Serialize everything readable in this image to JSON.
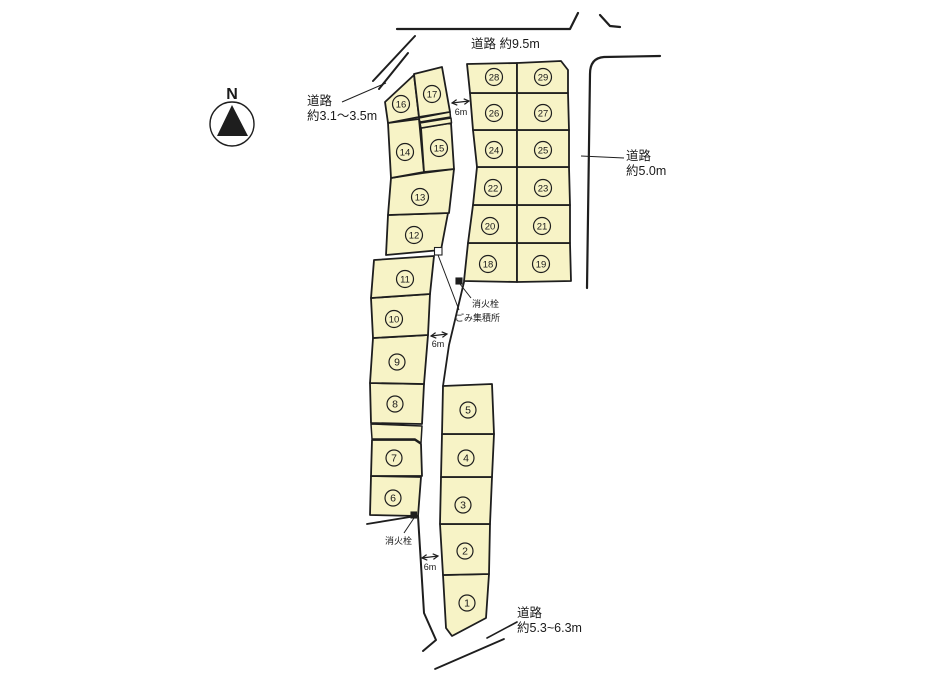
{
  "page": {
    "width": 947,
    "height": 681,
    "background": "#ffffff"
  },
  "colors": {
    "plot_fill": "#f7f3c6",
    "line": "#1e1e1e",
    "text": "#1a1a1a",
    "marker_dark": "#1e1e1e",
    "marker_light": "#ffffff"
  },
  "compass": {
    "label": "N",
    "cx": 232,
    "cy": 124,
    "r": 22
  },
  "road_labels": [
    {
      "id": "road-north",
      "lines": [
        "道路 約9.5m"
      ],
      "x": 471,
      "y": 48,
      "size": 12.5
    },
    {
      "id": "road-west",
      "lines": [
        "道路",
        "約3.1〜3.5m"
      ],
      "x": 307,
      "y": 105,
      "size": 12.5
    },
    {
      "id": "road-east",
      "lines": [
        "道路",
        "約5.0m"
      ],
      "x": 626,
      "y": 160,
      "size": 12.5
    },
    {
      "id": "road-south",
      "lines": [
        "道路",
        "約5.3~6.3m"
      ],
      "x": 517,
      "y": 617,
      "size": 12.5
    }
  ],
  "poi_labels": [
    {
      "id": "fire-hydrant-upper",
      "text": "消火栓",
      "x": 472,
      "y": 307,
      "size": 9
    },
    {
      "id": "garbage-station",
      "text": "ごみ集積所",
      "x": 455,
      "y": 321,
      "size": 9
    },
    {
      "id": "fire-hydrant-lower",
      "text": "消火栓",
      "x": 385,
      "y": 544,
      "size": 9
    }
  ],
  "dim_arrows": [
    {
      "id": "width-top",
      "x1": 452,
      "y1": 103,
      "x2": 469,
      "y2": 101,
      "label": "6m",
      "lx": 461,
      "ly": 115
    },
    {
      "id": "width-middle",
      "x1": 431,
      "y1": 336,
      "x2": 447,
      "y2": 334,
      "label": "6m",
      "lx": 438,
      "ly": 347
    },
    {
      "id": "width-bottom",
      "x1": 422,
      "y1": 558,
      "x2": 438,
      "y2": 556,
      "label": "6m",
      "lx": 430,
      "ly": 570
    }
  ],
  "markers": [
    {
      "id": "garbage-station-marker",
      "x": 434.5,
      "y": 247.5,
      "w": 7.5,
      "h": 7.5,
      "fill": "light"
    },
    {
      "id": "fire-hydrant-upper-marker",
      "x": 456,
      "y": 278,
      "w": 6,
      "h": 6,
      "fill": "dark"
    },
    {
      "id": "fire-hydrant-lower-marker",
      "x": 411,
      "y": 512,
      "w": 5.5,
      "h": 6,
      "fill": "dark"
    }
  ],
  "leader_lines": [
    {
      "id": "leader-road-west",
      "points": "342,102 386,83"
    },
    {
      "id": "leader-road-east",
      "points": "581,156 624,158"
    },
    {
      "id": "leader-garbage",
      "points": "438,255 459,310"
    },
    {
      "id": "leader-hydrant-up",
      "points": "460,284 471,298"
    },
    {
      "id": "leader-hydrant-lo",
      "points": "414,518 404,533"
    }
  ],
  "road_lines": [
    {
      "id": "road-top-edge",
      "points": "397,29 570,29 578,13",
      "w": 2.2
    },
    {
      "id": "road-top-corner",
      "points": "600,15 610,26 620,27",
      "w": 2.2
    },
    {
      "id": "road-east-edge",
      "path": "M660,56 L604,57 Q590,58 590,74 L587,288",
      "w": 2.2
    },
    {
      "id": "road-west-diag-outer",
      "points": "373,81 415,36",
      "w": 2
    },
    {
      "id": "road-west-diag-inner",
      "points": "379,89 408,53",
      "w": 2
    },
    {
      "id": "road-main-left-lower",
      "points": "418,516 424,613 436,640 423,651",
      "w": 2
    },
    {
      "id": "road-main-right-mid",
      "points": "464,282 455,320 449,345 443,386",
      "w": 1.8
    },
    {
      "id": "road-south-edge-a",
      "points": "517,622 487,638",
      "w": 1.6
    },
    {
      "id": "road-south-edge-b",
      "points": "504,639 435,669",
      "w": 1.8
    },
    {
      "id": "block-sliver-line",
      "points": "367,524 416,516",
      "w": 1.8
    }
  ],
  "strips": [
    {
      "id": "strip-17-15-a",
      "points": "419,118 450,112 450.5,117 420,122"
    },
    {
      "id": "strip-17-15-b",
      "points": "420,123 451,118 451.5,123 421,128"
    },
    {
      "id": "strip-8-7",
      "points": "371,424 422,426 421,443 415,439 372,439"
    }
  ],
  "plots": [
    {
      "n": "1",
      "points": "443,575 489,574 486,618 452,636 446,628",
      "cx": 467,
      "cy": 603
    },
    {
      "n": "2",
      "points": "440,524 490,524 489,574 443,575",
      "cx": 465,
      "cy": 551
    },
    {
      "n": "3",
      "points": "441,477 492,477 490,524 440,524",
      "cx": 463,
      "cy": 505
    },
    {
      "n": "4",
      "points": "442,434 494,434 492,477 441,477",
      "cx": 466,
      "cy": 458
    },
    {
      "n": "5",
      "points": "443,386 492,384 494,434 442,434",
      "cx": 468,
      "cy": 410
    },
    {
      "n": "6",
      "points": "371,476 421,477 418,516 370,515",
      "cx": 393,
      "cy": 498
    },
    {
      "n": "7",
      "points": "372,440 415,440 421,444 422,476 371,476",
      "cx": 394,
      "cy": 458
    },
    {
      "n": "8",
      "points": "370,383 424,384 422,424 371,423",
      "cx": 395,
      "cy": 404
    },
    {
      "n": "9",
      "points": "373,338 428,335 424,384 370,383",
      "cx": 397,
      "cy": 362
    },
    {
      "n": "10",
      "points": "371,298 430,294 428,335 373,338",
      "cx": 394,
      "cy": 319
    },
    {
      "n": "11",
      "points": "374,260 434,256 430,294 371,298",
      "cx": 405,
      "cy": 279
    },
    {
      "n": "12",
      "points": "388,215 448,213 441,250 386,255",
      "cx": 414,
      "cy": 235
    },
    {
      "n": "13",
      "points": "391,178 423,173 454,169 449,213 388,215",
      "cx": 420,
      "cy": 197
    },
    {
      "n": "14",
      "points": "388,123 419,119 424,172 391,178",
      "cx": 405,
      "cy": 152
    },
    {
      "n": "15",
      "points": "421,128 451,123 454,169 424,172",
      "cx": 439,
      "cy": 148
    },
    {
      "n": "16",
      "points": "385,102 414,75 419,117 388,123",
      "cx": 401,
      "cy": 104
    },
    {
      "n": "17",
      "points": "414,74 442,67 450,112 419,117",
      "cx": 432,
      "cy": 94
    },
    {
      "n": "18",
      "points": "468,243 517,243 517,282 464,281",
      "cx": 488,
      "cy": 264
    },
    {
      "n": "19",
      "points": "517,243 570,243 571,281 517,282",
      "cx": 541,
      "cy": 264
    },
    {
      "n": "20",
      "points": "473,205 517,205 517,243 468,243",
      "cx": 490,
      "cy": 226
    },
    {
      "n": "21",
      "points": "517,205 570,205 570,243 517,243",
      "cx": 542,
      "cy": 226
    },
    {
      "n": "22",
      "points": "477,167 517,167 517,205 473,205",
      "cx": 493,
      "cy": 188
    },
    {
      "n": "23",
      "points": "517,167 569,167 570,205 517,205",
      "cx": 543,
      "cy": 188
    },
    {
      "n": "24",
      "points": "473,130 517,130 517,167 477,167",
      "cx": 494,
      "cy": 150
    },
    {
      "n": "25",
      "points": "517,130 569,130 569,167 517,167",
      "cx": 543,
      "cy": 150
    },
    {
      "n": "26",
      "points": "470,93 517,93 517,130 473,130",
      "cx": 494,
      "cy": 113
    },
    {
      "n": "27",
      "points": "517,93 568,93 569,130 517,130",
      "cx": 543,
      "cy": 113
    },
    {
      "n": "28",
      "points": "467,64 517,63 517,93 470,93",
      "cx": 494,
      "cy": 77
    },
    {
      "n": "29",
      "points": "517,63 561,61 568,70 568,93 517,93",
      "cx": 543,
      "cy": 77
    }
  ]
}
